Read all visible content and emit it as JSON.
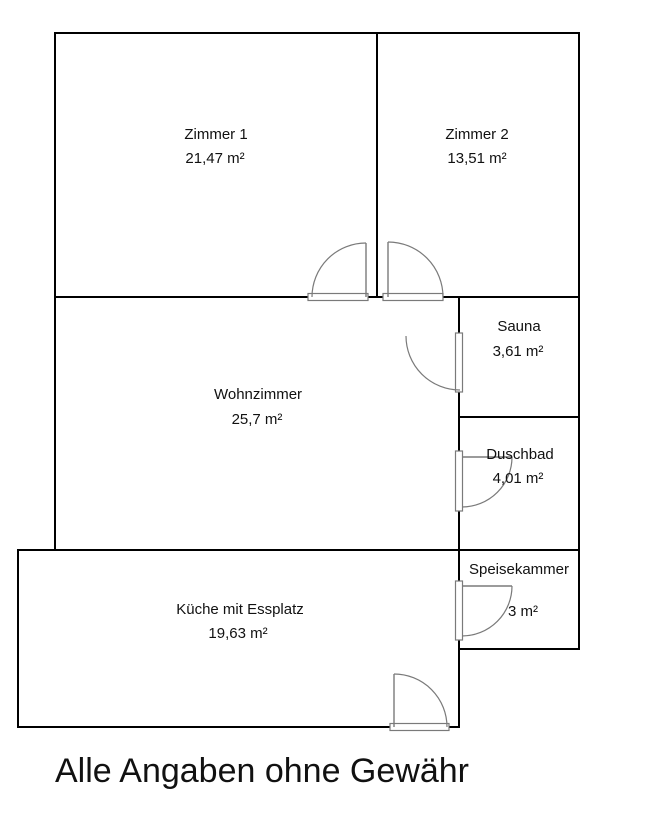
{
  "title": "Alle Angaben ohne Gewähr",
  "rooms": [
    {
      "name": "Zimmer 1",
      "area": "21,47 m²"
    },
    {
      "name": "Zimmer 2",
      "area": "13,51 m²"
    },
    {
      "name": "Sauna",
      "area": "3,61 m²"
    },
    {
      "name": "Wohnzimmer",
      "area": "25,7 m²"
    },
    {
      "name": "Duschbad",
      "area": "4,01 m²"
    },
    {
      "name": "Speisekammer",
      "area": "3 m²"
    },
    {
      "name": "Küche mit Essplatz",
      "area": "19,63 m²"
    }
  ],
  "colors": {
    "background": "#ffffff",
    "wall": "#000000",
    "door": "#7a7a7a",
    "text": "#111111"
  }
}
